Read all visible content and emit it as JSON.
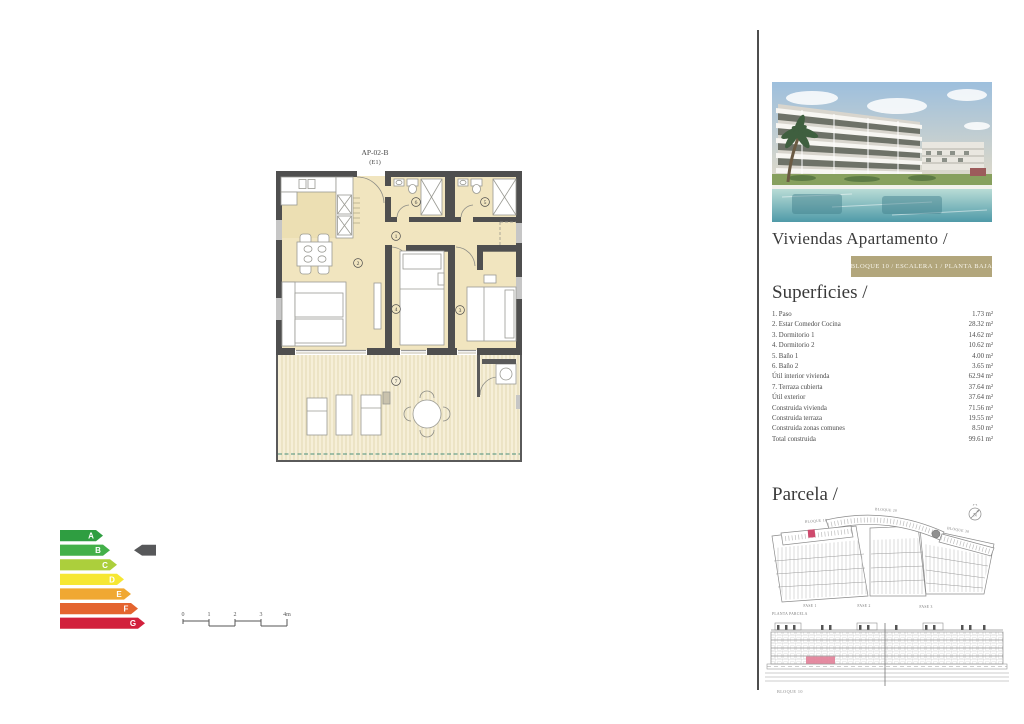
{
  "plan": {
    "title": "AP-02-B",
    "subtitle": "(E1)",
    "rooms": [
      {
        "num": "1"
      },
      {
        "num": "2"
      },
      {
        "num": "3"
      },
      {
        "num": "4"
      },
      {
        "num": "5"
      },
      {
        "num": "6"
      },
      {
        "num": "7"
      }
    ]
  },
  "scalebar": {
    "labels": [
      "0",
      "1",
      "2",
      "3",
      "4m"
    ]
  },
  "energy": {
    "grades": [
      {
        "letter": "A",
        "color": "#2f9e41"
      },
      {
        "letter": "B",
        "color": "#43b049"
      },
      {
        "letter": "C",
        "color": "#accf3c"
      },
      {
        "letter": "D",
        "color": "#f6e733"
      },
      {
        "letter": "E",
        "color": "#f0a832"
      },
      {
        "letter": "F",
        "color": "#e4642f"
      },
      {
        "letter": "G",
        "color": "#d2203c"
      }
    ],
    "indicator_grade": "B",
    "indicator_color": "#57585a"
  },
  "sidebar": {
    "title": "Viviendas Apartamento /",
    "badge": "BLOQUE 10 / ESCALERA 1 / PLANTA BAJA",
    "superficies": {
      "heading": "Superficies /",
      "rows": [
        {
          "label": "1. Paso",
          "value": "1.73 m²"
        },
        {
          "label": "2. Estar Comedor Cocina",
          "value": "28.32 m²"
        },
        {
          "label": "3. Dormitorio 1",
          "value": "14.62 m²"
        },
        {
          "label": "4. Dormitorio 2",
          "value": "10.62 m²"
        },
        {
          "label": "5. Baño 1",
          "value": "4.00 m²"
        },
        {
          "label": "6. Baño 2",
          "value": "3.65 m²"
        },
        {
          "label": "Útil interior vivienda",
          "value": "62.94 m²"
        },
        {
          "label": "7. Terraza cubierta",
          "value": "37.64 m²"
        },
        {
          "label": "Útil exterior",
          "value": "37.64 m²"
        },
        {
          "label": "Construida vivienda",
          "value": "71.56 m²"
        },
        {
          "label": "Construida terraza",
          "value": "19.55 m²"
        },
        {
          "label": "Construida zonas comunes",
          "value": "8.50 m²"
        },
        {
          "label": "Total construida",
          "value": "99.61 m²"
        }
      ]
    },
    "parcela": {
      "heading": "Parcela /",
      "labels": {
        "bloque10": "BLOQUE 10",
        "bloque20": "BLOQUE 20",
        "bloque30": "BLOQUE 30",
        "fase1": "FASE 1",
        "fase2": "FASE 2",
        "fase3": "FASE 3",
        "caption": "PLANTA PARCELA",
        "compass": "N"
      },
      "highlight_color": "#ce4a6d"
    },
    "elevation": {
      "caption": "BLOQUE 10",
      "highlight_color": "#e27f98"
    }
  }
}
